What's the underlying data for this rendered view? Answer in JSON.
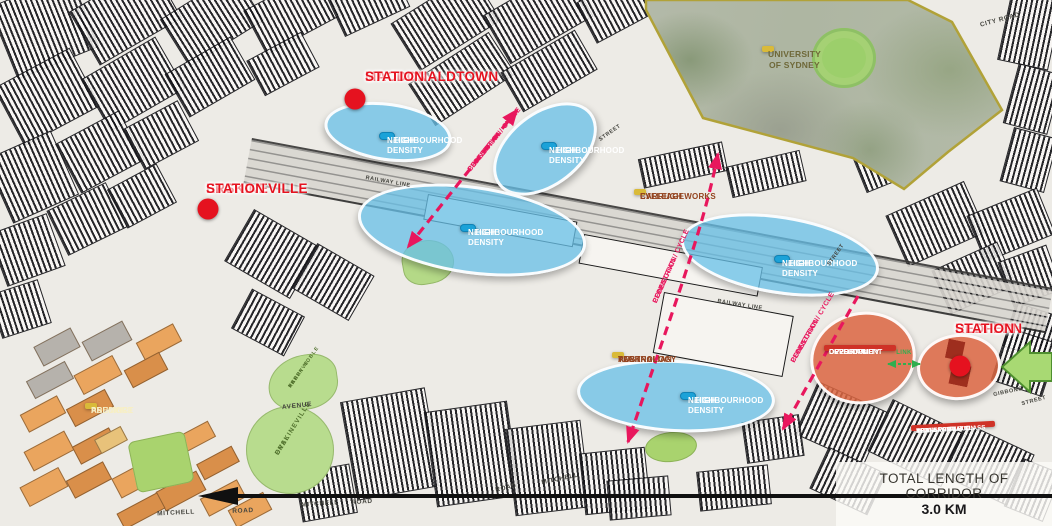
{
  "stations": {
    "macdonaldtown": {
      "line1": "MACDONALDTOWN",
      "line2": "STATION"
    },
    "erskineville": {
      "line1": "ERSKINEVILLE",
      "line2": "STATION"
    },
    "redfern": {
      "line1": "REDFERN",
      "line2": "STATION"
    }
  },
  "precincts": {
    "university_of_sydney": "UNIVERSITY OF SYDNEY",
    "eveleigh_carriageworks": {
      "line1": "EVELEIGH",
      "line2": "CARRIAGEWORKS"
    },
    "australian_technology_park": {
      "line1": "AUSTRALIAN",
      "line2": "TECHNOLOGY",
      "line3": "PARK"
    },
    "ashmore_precinct": {
      "line1": "ASHMORE",
      "line2": "PRECINCT"
    }
  },
  "zones": {
    "high_density": {
      "line1": "HIGH DENSITY",
      "line2": "NEIGHBOURHOOD"
    },
    "development_opportunity": {
      "line1": "DEVELOPMENT",
      "line2": "OPPORTUNITY",
      "line3": "OVER RAIL"
    },
    "transform_redfern": {
      "line1": "TRANSFORM",
      "line2": "REDFERN STATION",
      "line3": "INTO A WORLD CLASS",
      "line4": "TRANSPORT HUB"
    }
  },
  "connections": {
    "pedestrian_cycle": {
      "line1": "PEDESTRIAN / CYCLE",
      "line2": "CONNECTION"
    },
    "link": "LINK"
  },
  "scale": {
    "title": "TOTAL LENGTH OF CORRIDOR",
    "length": "3.0 KM"
  },
  "streets": {
    "city_road": "CITY ROAD",
    "mitchell_1": "MITCHELL",
    "road_1": "ROAD",
    "mitchell_2": "MITCHELL",
    "road_2": "ROAD",
    "mitchell_3": "MITCHELL",
    "road_3": "ROAD",
    "railway_line_1": "RAILWAY LINE",
    "railway_line_2": "RAILWAY LINE",
    "avenue": "AVENUE",
    "street_1": "STREET",
    "street_2": "STREET",
    "gibbons": "GIBBONS",
    "street_3": "STREET"
  },
  "parks": {
    "erskineville_oval": {
      "line1": "ERSKINEVILLE",
      "line2": "OVAL"
    },
    "harry_noble": {
      "line1": "THE",
      "line2": "HARRY NOBLE",
      "line3": "RESERVE"
    }
  },
  "colors": {
    "high_density_fill": "#68c0e7",
    "label_blue": "#1ba2d8",
    "station_red": "#e5121f",
    "connection_pink": "#e8175d",
    "precinct_yellow": "#d9ba39",
    "development_orange": "#db6642",
    "action_red": "#cf3227",
    "link_green": "#2fae4f",
    "arrow_green": "#a8d973"
  }
}
